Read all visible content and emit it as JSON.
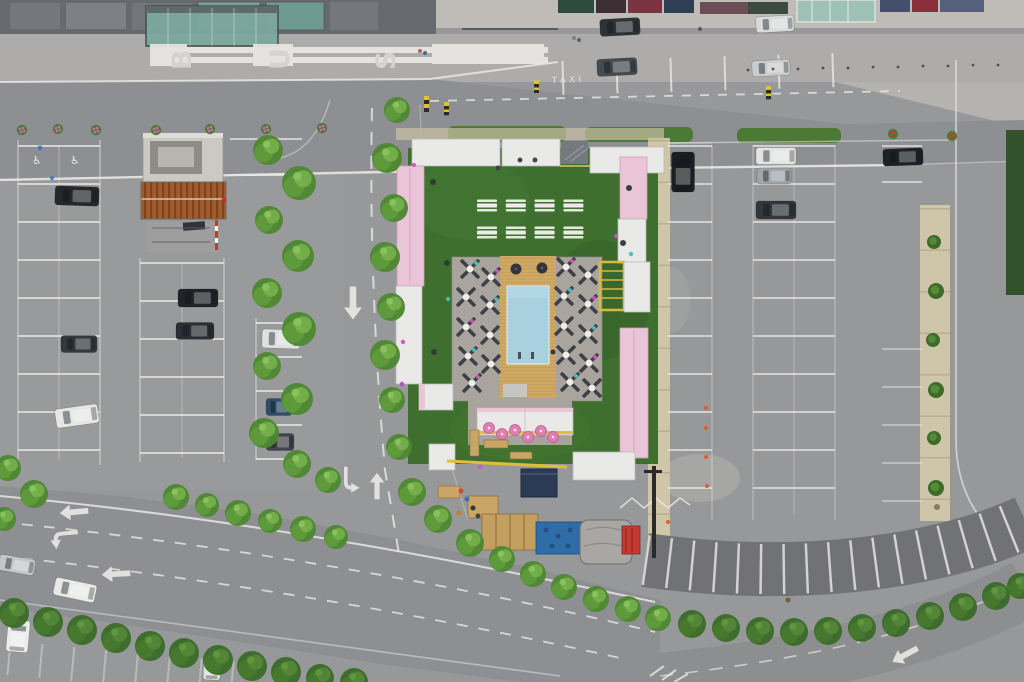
{
  "scene": {
    "type": "aerial-drone-photograph",
    "description": "Top-down drone view of a pop-up beach club with a swimming pool, wooden deck, sun loungers, picnic tables and artificial turf, enclosed by white and pink containers, built in the middle of a large parking lot. A bus stop and taxi rank line the road at top; a tree-lined multi-lane road curves along the bottom."
  },
  "markings": {
    "bus_label": "BUS",
    "bus_letters": [
      "B",
      "U",
      "S"
    ],
    "taxi_label": "TAXI"
  },
  "palette": {
    "asphalt": "#97989a",
    "road": "#8e8f92",
    "sidewalk": "#adacaa",
    "path_beige": "#cfc5a9",
    "turf": "#3f6f2e",
    "terrace": "#a9a49d",
    "pool_water": "#a9d0de",
    "deck_wood": "#cfa963",
    "container_white": "#e9eae8",
    "container_pink": "#eac5d8",
    "rust_roof": "#a05c2e",
    "line_white": "#e9e8e4",
    "hedge_green": "#4c7a34",
    "accent_yellow": "#ddbf3a",
    "tent_navy": "#2c3a55"
  },
  "club": {
    "picnic_tables": {
      "x0": 477,
      "y0": 205,
      "dx": 28.8,
      "dy": 27,
      "rows": 2,
      "cols": 4,
      "w": 20
    },
    "lounger_clusters": [
      [
        470,
        269,
        "t"
      ],
      [
        491,
        277,
        "m"
      ],
      [
        466,
        297,
        null
      ],
      [
        490,
        305,
        "t"
      ],
      [
        466,
        327,
        "m"
      ],
      [
        490,
        335,
        null
      ],
      [
        468,
        356,
        "t"
      ],
      [
        491,
        364,
        null
      ],
      [
        472,
        383,
        "m"
      ],
      [
        566,
        267,
        "m"
      ],
      [
        588,
        275,
        null
      ],
      [
        564,
        296,
        "t"
      ],
      [
        588,
        304,
        "m"
      ],
      [
        564,
        326,
        null
      ],
      [
        588,
        334,
        "t"
      ],
      [
        566,
        355,
        null
      ],
      [
        589,
        363,
        "m"
      ],
      [
        570,
        382,
        "t"
      ],
      [
        592,
        388,
        null
      ]
    ],
    "umbrellas": [
      [
        489,
        428
      ],
      [
        502,
        434
      ],
      [
        515,
        430
      ],
      [
        528,
        437
      ],
      [
        541,
        431
      ],
      [
        553,
        437
      ]
    ]
  },
  "vegetation": {
    "trees": [
      [
        268,
        150,
        15,
        0
      ],
      [
        299,
        183,
        17,
        0
      ],
      [
        269,
        220,
        14,
        0
      ],
      [
        298,
        256,
        16,
        0
      ],
      [
        267,
        293,
        15,
        0
      ],
      [
        299,
        329,
        17,
        0
      ],
      [
        267,
        366,
        14,
        0
      ],
      [
        297,
        399,
        16,
        0
      ],
      [
        264,
        433,
        15,
        0
      ],
      [
        297,
        464,
        14,
        0
      ],
      [
        328,
        480,
        13,
        0
      ],
      [
        397,
        110,
        13,
        0
      ],
      [
        387,
        158,
        15,
        0
      ],
      [
        394,
        208,
        14,
        0
      ],
      [
        385,
        257,
        15,
        0
      ],
      [
        391,
        307,
        14,
        0
      ],
      [
        385,
        355,
        15,
        0
      ],
      [
        392,
        400,
        13,
        0
      ],
      [
        399,
        447,
        13,
        0
      ],
      [
        412,
        492,
        14,
        0
      ],
      [
        438,
        519,
        14,
        0
      ],
      [
        470,
        543,
        14,
        0
      ],
      [
        502,
        559,
        13,
        0
      ],
      [
        533,
        574,
        13,
        0
      ],
      [
        564,
        587,
        13,
        0
      ],
      [
        596,
        599,
        13,
        0
      ],
      [
        628,
        609,
        13,
        0
      ],
      [
        658,
        618,
        13,
        0
      ],
      [
        176,
        497,
        13,
        0
      ],
      [
        207,
        505,
        12,
        0
      ],
      [
        238,
        513,
        13,
        0
      ],
      [
        270,
        521,
        12,
        0
      ],
      [
        303,
        529,
        13,
        0
      ],
      [
        336,
        537,
        12,
        0
      ],
      [
        8,
        468,
        13,
        0
      ],
      [
        34,
        494,
        14,
        0
      ],
      [
        4,
        519,
        12,
        0
      ],
      [
        14,
        613,
        15,
        1
      ],
      [
        48,
        622,
        15,
        1
      ],
      [
        82,
        630,
        15,
        1
      ],
      [
        116,
        638,
        15,
        1
      ],
      [
        150,
        646,
        15,
        1
      ],
      [
        184,
        653,
        15,
        1
      ],
      [
        218,
        660,
        15,
        1
      ],
      [
        252,
        666,
        15,
        1
      ],
      [
        286,
        672,
        15,
        1
      ],
      [
        320,
        678,
        14,
        1
      ],
      [
        354,
        682,
        14,
        1
      ],
      [
        692,
        624,
        14,
        1
      ],
      [
        726,
        628,
        14,
        1
      ],
      [
        760,
        631,
        14,
        1
      ],
      [
        794,
        632,
        14,
        1
      ],
      [
        828,
        631,
        14,
        1
      ],
      [
        862,
        628,
        14,
        1
      ],
      [
        896,
        623,
        14,
        1
      ],
      [
        930,
        616,
        14,
        1
      ],
      [
        963,
        607,
        14,
        1
      ],
      [
        996,
        596,
        14,
        1
      ],
      [
        1020,
        586,
        13,
        1
      ]
    ],
    "bushes": [
      [
        934,
        242,
        7
      ],
      [
        936,
        291,
        8
      ],
      [
        933,
        340,
        7
      ],
      [
        936,
        390,
        8
      ],
      [
        934,
        438,
        7
      ],
      [
        936,
        488,
        8
      ],
      [
        938,
        240,
        0
      ]
    ],
    "flower_planters": [
      [
        22,
        130,
        "#cf6bb0"
      ],
      [
        58,
        129,
        "#cf6bb0"
      ],
      [
        96,
        130,
        "#cf6bb0"
      ],
      [
        156,
        130,
        "#cf6bb0"
      ],
      [
        210,
        129,
        "#cf6bb0"
      ],
      [
        266,
        129,
        "#cf6bb0"
      ],
      [
        322,
        128,
        "#cf6bb0"
      ],
      [
        893,
        134,
        "#c23a34"
      ],
      [
        952,
        136,
        "#c23a34"
      ]
    ]
  },
  "vehicles": {
    "cars": [
      [
        620,
        27,
        40,
        17,
        -3,
        "#2e3336"
      ],
      [
        775,
        24,
        38,
        16,
        -3,
        "#d9dbdb"
      ],
      [
        617,
        67,
        40,
        17,
        -3,
        "#454b4f"
      ],
      [
        771,
        68,
        38,
        16,
        -3,
        "#c9cccd"
      ],
      [
        77,
        196,
        44,
        19,
        2,
        "#24282b"
      ],
      [
        198,
        298,
        40,
        18,
        0,
        "#202427"
      ],
      [
        195,
        331,
        38,
        17,
        0,
        "#2b2f33"
      ],
      [
        79,
        344,
        36,
        17,
        0,
        "#33383c"
      ],
      [
        77,
        416,
        43,
        19,
        -8,
        "#e6e7e5"
      ],
      [
        281,
        339,
        38,
        19,
        2,
        "#dfe1e1"
      ],
      [
        279,
        407,
        26,
        17,
        0,
        "#2e4d66"
      ],
      [
        280,
        442,
        28,
        17,
        0,
        "#3f4449"
      ],
      [
        683,
        172,
        40,
        23,
        90,
        "#1b1e21"
      ],
      [
        776,
        156,
        40,
        17,
        0,
        "#e2e4e3"
      ],
      [
        774,
        176,
        34,
        16,
        0,
        "#9fa5a8"
      ],
      [
        776,
        210,
        40,
        18,
        0,
        "#31373b"
      ],
      [
        903,
        157,
        40,
        17,
        -2,
        "#1e2225"
      ],
      [
        17,
        565,
        36,
        16,
        10,
        "#c4c7c9"
      ],
      [
        75,
        590,
        42,
        18,
        12,
        "#e9eae8"
      ],
      [
        18,
        636,
        32,
        22,
        95,
        "#ecedeb"
      ],
      [
        212,
        666,
        28,
        17,
        92,
        "#dde3da"
      ]
    ]
  },
  "road_arrows": [
    [
      74,
      512,
      -95,
      "straight",
      1.3
    ],
    [
      64,
      538,
      -95,
      "turn",
      1.3
    ],
    [
      116,
      574,
      -93,
      "straight",
      1.3
    ],
    [
      353,
      303,
      180,
      "straight",
      1.5
    ],
    [
      350,
      480,
      180,
      "turn",
      1.2
    ],
    [
      377,
      486,
      0,
      "straight",
      1.2
    ],
    [
      905,
      655,
      -118,
      "straight",
      1.3
    ]
  ],
  "small_objects": [
    [
      748,
      70,
      1.4,
      "#4a4a4c"
    ],
    [
      773,
      69,
      1.4,
      "#4a4a4c"
    ],
    [
      798,
      69,
      1.4,
      "#4a4a4c"
    ],
    [
      823,
      68,
      1.4,
      "#4a4a4c"
    ],
    [
      848,
      68,
      1.4,
      "#4a4a4c"
    ],
    [
      873,
      67,
      1.4,
      "#4a4a4c"
    ],
    [
      898,
      67,
      1.4,
      "#4a4a4c"
    ],
    [
      923,
      66,
      1.4,
      "#4a4a4c"
    ],
    [
      948,
      66,
      1.4,
      "#4a4a4c"
    ],
    [
      973,
      65,
      1.4,
      "#4a4a4c"
    ],
    [
      998,
      65,
      1.4,
      "#4a4a4c"
    ],
    [
      420,
      51,
      2,
      "#b8545e"
    ],
    [
      425,
      53,
      2,
      "#46628c"
    ],
    [
      574,
      38,
      2,
      "#7a8088"
    ],
    [
      579,
      40,
      2,
      "#555c64"
    ],
    [
      700,
      29,
      2,
      "#50565c"
    ],
    [
      461,
      491,
      2.5,
      "#cc4636"
    ],
    [
      467,
      499,
      2.5,
      "#3a6cae"
    ],
    [
      473,
      508,
      2.5,
      "#25303c"
    ],
    [
      459,
      513,
      2.5,
      "#c87c28"
    ],
    [
      478,
      516,
      2.5,
      "#30404e"
    ],
    [
      433,
      182,
      3,
      "#2c3830"
    ],
    [
      447,
      263,
      3,
      "#2c3830"
    ],
    [
      629,
      188,
      3,
      "#2c3830"
    ],
    [
      623,
      243,
      3,
      "#2c3830"
    ],
    [
      553,
      352,
      2.5,
      "#2c3830"
    ],
    [
      434,
      352,
      3,
      "#2c3830"
    ],
    [
      520,
      160,
      2.5,
      "#3a423e"
    ],
    [
      535,
      160,
      2.5,
      "#3a423e"
    ],
    [
      498,
      168,
      2.5,
      "#3a423e"
    ],
    [
      631,
      254,
      2.2,
      "#3ec0ba"
    ],
    [
      448,
      299,
      2.2,
      "#3ec0ba"
    ],
    [
      616,
      236,
      2,
      "#d649c8"
    ],
    [
      403,
      342,
      2.2,
      "#d24fc8"
    ],
    [
      402,
      384,
      2.2,
      "#b845d4"
    ],
    [
      480,
      467,
      2.2,
      "#cc50d0"
    ],
    [
      414,
      165,
      2,
      "#d24fc8"
    ],
    [
      706,
      408,
      2,
      "#e05a28"
    ],
    [
      706,
      428,
      2,
      "#e05a28"
    ],
    [
      706,
      457,
      2,
      "#e05a28"
    ],
    [
      707,
      486,
      2,
      "#e05a28"
    ],
    [
      668,
      522,
      2,
      "#e05a28"
    ],
    [
      224,
      200,
      2.5,
      "#b73527"
    ],
    [
      40,
      148,
      2.5,
      "#3f7ac0"
    ],
    [
      52,
      178,
      2,
      "#3f7ac0"
    ],
    [
      937,
      507,
      3,
      "#8a7558"
    ],
    [
      788,
      600,
      2.5,
      "#6f5a42"
    ]
  ]
}
